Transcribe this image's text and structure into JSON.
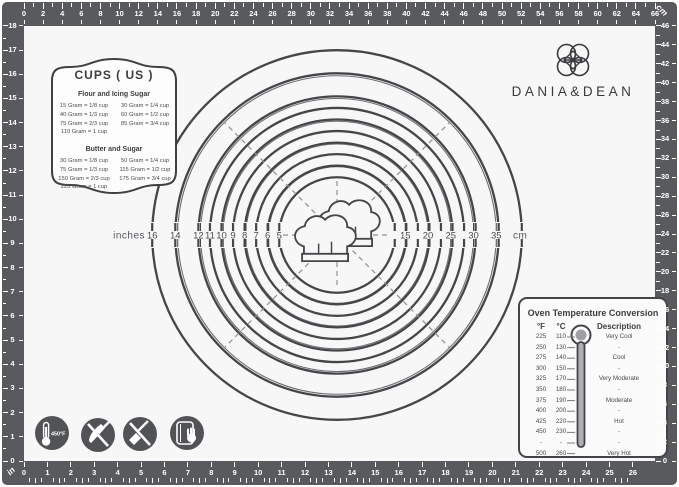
{
  "brand": {
    "name": "DANIA&DEAN"
  },
  "cups_box": {
    "title": "CUPS ( US )",
    "sections": [
      {
        "heading": "Flour and Icing Sugar",
        "left": [
          "15 Gram = 1/8 cup",
          "40 Gram = 1/3 cup",
          "75 Gram = 2/3 cup",
          "110 Gram =  1 cup"
        ],
        "right": [
          "30 Gram = 1/4 cup",
          "60 Gram = 1/2 cup",
          "85 Gram = 3/4 cup"
        ]
      },
      {
        "heading": "Butter and Sugar",
        "left": [
          "30 Gram = 1/8 cup",
          "75 Gram = 1/3 cup",
          "150 Gram = 2/3 cup",
          "225 Gram =  1 cup"
        ],
        "right": [
          "50 Gram = 1/4 cup",
          "115 Gram = 1/2 cup",
          "175 Gram = 3/4 cup"
        ]
      }
    ]
  },
  "dial": {
    "left_unit": "inches",
    "right_unit": "cm",
    "inch_diameters": [
      16,
      14,
      12,
      11,
      10,
      9,
      8,
      7,
      6,
      5
    ],
    "cm_diameters": [
      15,
      20,
      25,
      30,
      35
    ]
  },
  "oven_table": {
    "title": "Oven Temperature Conversion",
    "columns": {
      "f": "°F",
      "c": "°C",
      "desc": "Description"
    },
    "rows": [
      {
        "f": "225",
        "c": "110",
        "desc": "Very Cool"
      },
      {
        "f": "250",
        "c": "130",
        "desc": "-"
      },
      {
        "f": "275",
        "c": "140",
        "desc": "Cool"
      },
      {
        "f": "300",
        "c": "150",
        "desc": "-"
      },
      {
        "f": "325",
        "c": "170",
        "desc": "Very Moderate"
      },
      {
        "f": "350",
        "c": "180",
        "desc": "-"
      },
      {
        "f": "375",
        "c": "190",
        "desc": "Moderate"
      },
      {
        "f": "400",
        "c": "200",
        "desc": "-"
      },
      {
        "f": "425",
        "c": "220",
        "desc": "Hot"
      },
      {
        "f": "450",
        "c": "230",
        "desc": "-"
      },
      {
        "f": "-",
        "c": "-",
        "desc": "-"
      },
      {
        "f": "500",
        "c": "260",
        "desc": "Very Hot"
      }
    ]
  },
  "badges": {
    "heat_label": "450°F"
  },
  "rulers": {
    "top": {
      "unit": "cm",
      "min": 0,
      "max": 66,
      "label_step": 2
    },
    "right": {
      "unit": "cm",
      "min": 0,
      "max": 46,
      "label_step": 2,
      "corner_label": "cm"
    },
    "bottom": {
      "unit": "inch",
      "min": 0,
      "max": 26,
      "label_step": 1,
      "corner_label": "in"
    },
    "left": {
      "unit": "inch",
      "min": 0,
      "max": 18,
      "label_step": 1
    }
  },
  "colors": {
    "frame": "#595a5d",
    "surface": "#f7f7f8",
    "ink": "#454649",
    "thin_line": "#6f7073",
    "badge": "#515356",
    "white": "#ffffff"
  }
}
